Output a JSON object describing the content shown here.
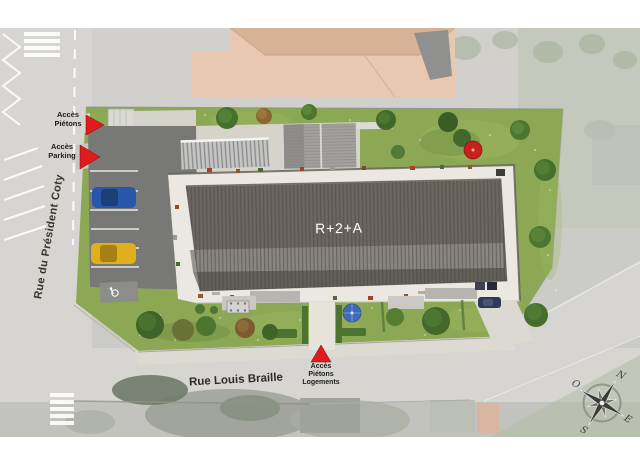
{
  "plan": {
    "building_label": "R+2+A",
    "streets": {
      "west": "Rue du Président Coty",
      "south": "Rue Louis Braille"
    },
    "access": {
      "pietons": "Accès\nPiétons",
      "parking": "Accès\nParking",
      "pietons_logements": "Accès\nPiétons\nLogements"
    },
    "compass": {
      "north": "N",
      "east": "E",
      "south": "S",
      "west": "O"
    },
    "colors": {
      "access_marker": "#e11b1d",
      "lawn": "#8ca855",
      "main_roof": "#6b675f",
      "walkway": "#ebe8e1",
      "road": "#d6d5d2",
      "neighbor_roof": "#e9c8b1"
    }
  }
}
